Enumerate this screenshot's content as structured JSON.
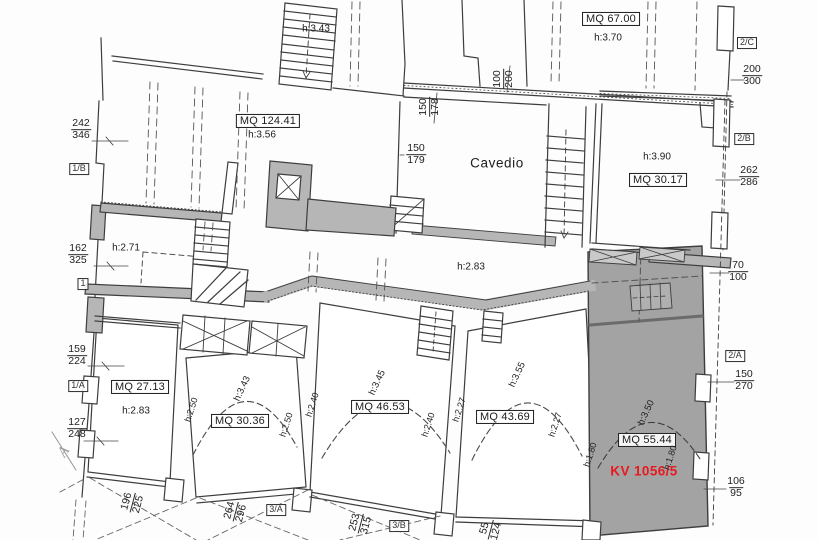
{
  "colors": {
    "wall_gray": "#b6b6b6",
    "dark_zone": "#a3a3a3",
    "parcel_red": "#e8191f"
  },
  "rooms": {
    "mq124": {
      "area": "MQ 124.41",
      "height": "h:3.56"
    },
    "top": {
      "height": "h:3.43"
    },
    "mq67": {
      "area": "MQ 67.00",
      "height": "h:3.70"
    },
    "mq3017": {
      "area": "MQ 30.17",
      "height": "h:3.90"
    },
    "cavedio": {
      "name": "Cavedio"
    },
    "h271": {
      "height": "h:2.71"
    },
    "corridor": {
      "height": "h:2.83"
    },
    "mq2713": {
      "area": "MQ 27.13",
      "height": "h:2.83"
    },
    "mq3036": {
      "area": "MQ 30.36",
      "vault_height": "h:3.43"
    },
    "mq4653": {
      "area": "MQ 46.53",
      "vault_height": "h:3.45"
    },
    "mq4369": {
      "area": "MQ 43.69",
      "vault_height": "h:3.55"
    },
    "mq5544": {
      "area": "MQ 55.44",
      "vault_height": "h:3.50",
      "parcel": "KV 1056/5"
    }
  },
  "wall_heights": {
    "w250a": "h:2.50",
    "w250b": "h:2.50",
    "w240a": "h:2.40",
    "w240b": "h:2.40",
    "w227a": "h:2.27",
    "w227b": "h:2.27",
    "w180a": "h:1.80",
    "w180b": "h:1.80"
  },
  "tags": {
    "t1b": "1/B",
    "t1": "1",
    "t1a": "1/A",
    "t2c": "2/C",
    "t2b": "2/B",
    "t2a": "2/A",
    "t3a": "3/A",
    "t3b": "3/B"
  },
  "dims": {
    "d242_346": {
      "top": "242",
      "bottom": "346"
    },
    "d162_325": {
      "top": "162",
      "bottom": "325"
    },
    "d159_224": {
      "top": "159",
      "bottom": "224"
    },
    "d127_248": {
      "top": "127",
      "bottom": "248"
    },
    "d200_300": {
      "top": "200",
      "bottom": "300"
    },
    "d262_286": {
      "top": "262",
      "bottom": "286"
    },
    "d70_100": {
      "top": "70",
      "bottom": "100"
    },
    "d150_270": {
      "top": "150",
      "bottom": "270"
    },
    "d106_95": {
      "top": "106",
      "bottom": "95"
    },
    "d100_200": {
      "top": "100",
      "bottom": "200"
    },
    "d150_178": {
      "top": "150",
      "bottom": "178"
    },
    "d150_179": {
      "top": "150",
      "bottom": "179"
    },
    "d196_225": {
      "top": "196",
      "bottom": "225"
    },
    "d264_296": {
      "top": "264",
      "bottom": "296"
    },
    "d253_315": {
      "top": "253",
      "bottom": "315"
    },
    "d55_124": {
      "top": "55",
      "bottom": "124"
    }
  },
  "section_mark": "A"
}
